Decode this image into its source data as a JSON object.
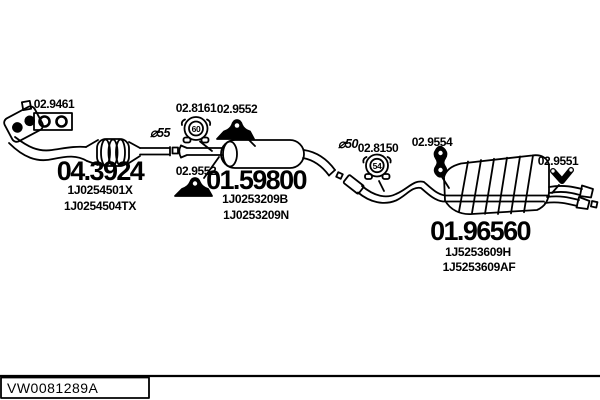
{
  "diagram": {
    "parts": [
      {
        "number": "04.3924",
        "oem_codes": [
          "1J0254501X",
          "1J0254504TX"
        ],
        "component": "catalytic-converter-front-pipe"
      },
      {
        "number": "01.59800",
        "oem_codes": [
          "1J0253209B",
          "1J0253209N"
        ],
        "component": "middle-silencer"
      },
      {
        "number": "01.96560",
        "oem_codes": [
          "1J5253609H",
          "1J5253609AF"
        ],
        "component": "rear-silencer"
      }
    ],
    "fittings": [
      {
        "label": "02.9461",
        "icon": "gasket-icon"
      },
      {
        "label": "02.8161",
        "icon": "clamp-icon",
        "size": "60"
      },
      {
        "label": "02.9552",
        "icon": "rubber-mount-icon"
      },
      {
        "label": "02.9552",
        "icon": "rubber-mount-icon"
      },
      {
        "label": "02.8150",
        "icon": "clamp-icon",
        "size": "54"
      },
      {
        "label": "02.9554",
        "icon": "hanger-icon"
      },
      {
        "label": "02.9551",
        "icon": "hanger-icon"
      }
    ],
    "markers": [
      {
        "text": "⌀55"
      },
      {
        "text": "⌀50"
      }
    ]
  },
  "footer": {
    "code": "VW0081289A"
  },
  "colors": {
    "line": "#000000",
    "background": "#ffffff"
  }
}
